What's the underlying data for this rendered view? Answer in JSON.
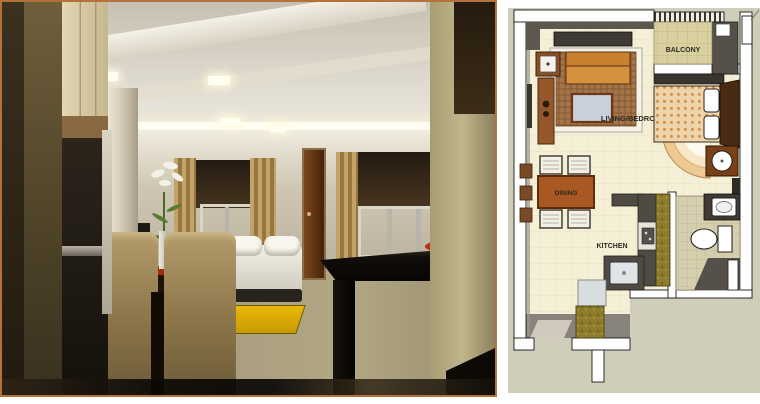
{
  "colors": {
    "render-border": "#b5713a",
    "plan-bg": "#d0cdba",
    "plan-floor": "#f4efd5",
    "wall-white": "#ffffff",
    "wall-shade": "#5c5850",
    "sofa-orange": "#d6913f",
    "granite-olive": "#8d7c2c",
    "rug-yellow": "#e2ae08"
  },
  "floorplan": {
    "labels": {
      "balcony": "BALCONY",
      "living_bedroom": "LIVING/BEDROOM",
      "dining": "DINING",
      "kitchen": "KITCHEN"
    }
  }
}
